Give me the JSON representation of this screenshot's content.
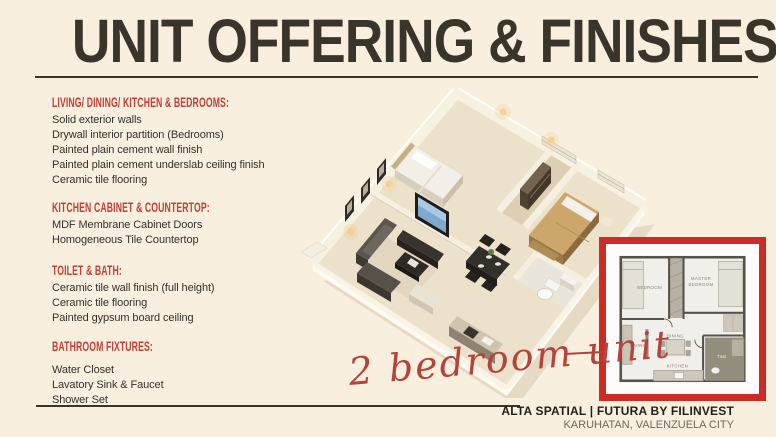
{
  "slide": {
    "title": "UNIT OFFERING & FINISHES"
  },
  "sections": [
    {
      "heading": "LIVING/ DINING/ KITCHEN & BEDROOMS:",
      "items": [
        "Solid exterior walls",
        "Drywall interior partition (Bedrooms)",
        "Painted plain cement wall finish",
        "Painted plain cement underslab ceiling finish",
        "Ceramic tile flooring"
      ]
    },
    {
      "heading": "KITCHEN CABINET & COUNTERTOP:",
      "items": [
        "MDF Membrane Cabinet Doors",
        "Homogeneous Tile Countertop"
      ]
    },
    {
      "heading": "TOILET & BATH:",
      "items": [
        "Ceramic tile wall finish (full height)",
        "Ceramic tile flooring",
        "Painted gypsum board ceiling"
      ]
    },
    {
      "heading": "BATHROOM FIXTURES:",
      "items": [
        "Water Closet",
        "Lavatory Sink & Faucet",
        "Shower Set"
      ]
    }
  ],
  "annotation": {
    "label": "2 bedroom unit"
  },
  "floorplan": {
    "rooms": {
      "bedroom": "BEDROOM",
      "master_line1": "MASTER",
      "master_line2": "BEDROOM",
      "living": "LIVING",
      "dining": "DINING",
      "kitchen": "KITCHEN",
      "toilet_bath": "T&B"
    }
  },
  "footer": {
    "project": "ALTA SPATIAL | FUTURA BY FILINVEST",
    "location": "KARUHATAN, VALENZUELA CITY"
  },
  "colors": {
    "background": "#f8efde",
    "title_text": "#3a352b",
    "accent_red": "#c2403a",
    "frame_red": "#cb2d26",
    "script_red": "#b5433d",
    "body_text": "#33312c"
  }
}
